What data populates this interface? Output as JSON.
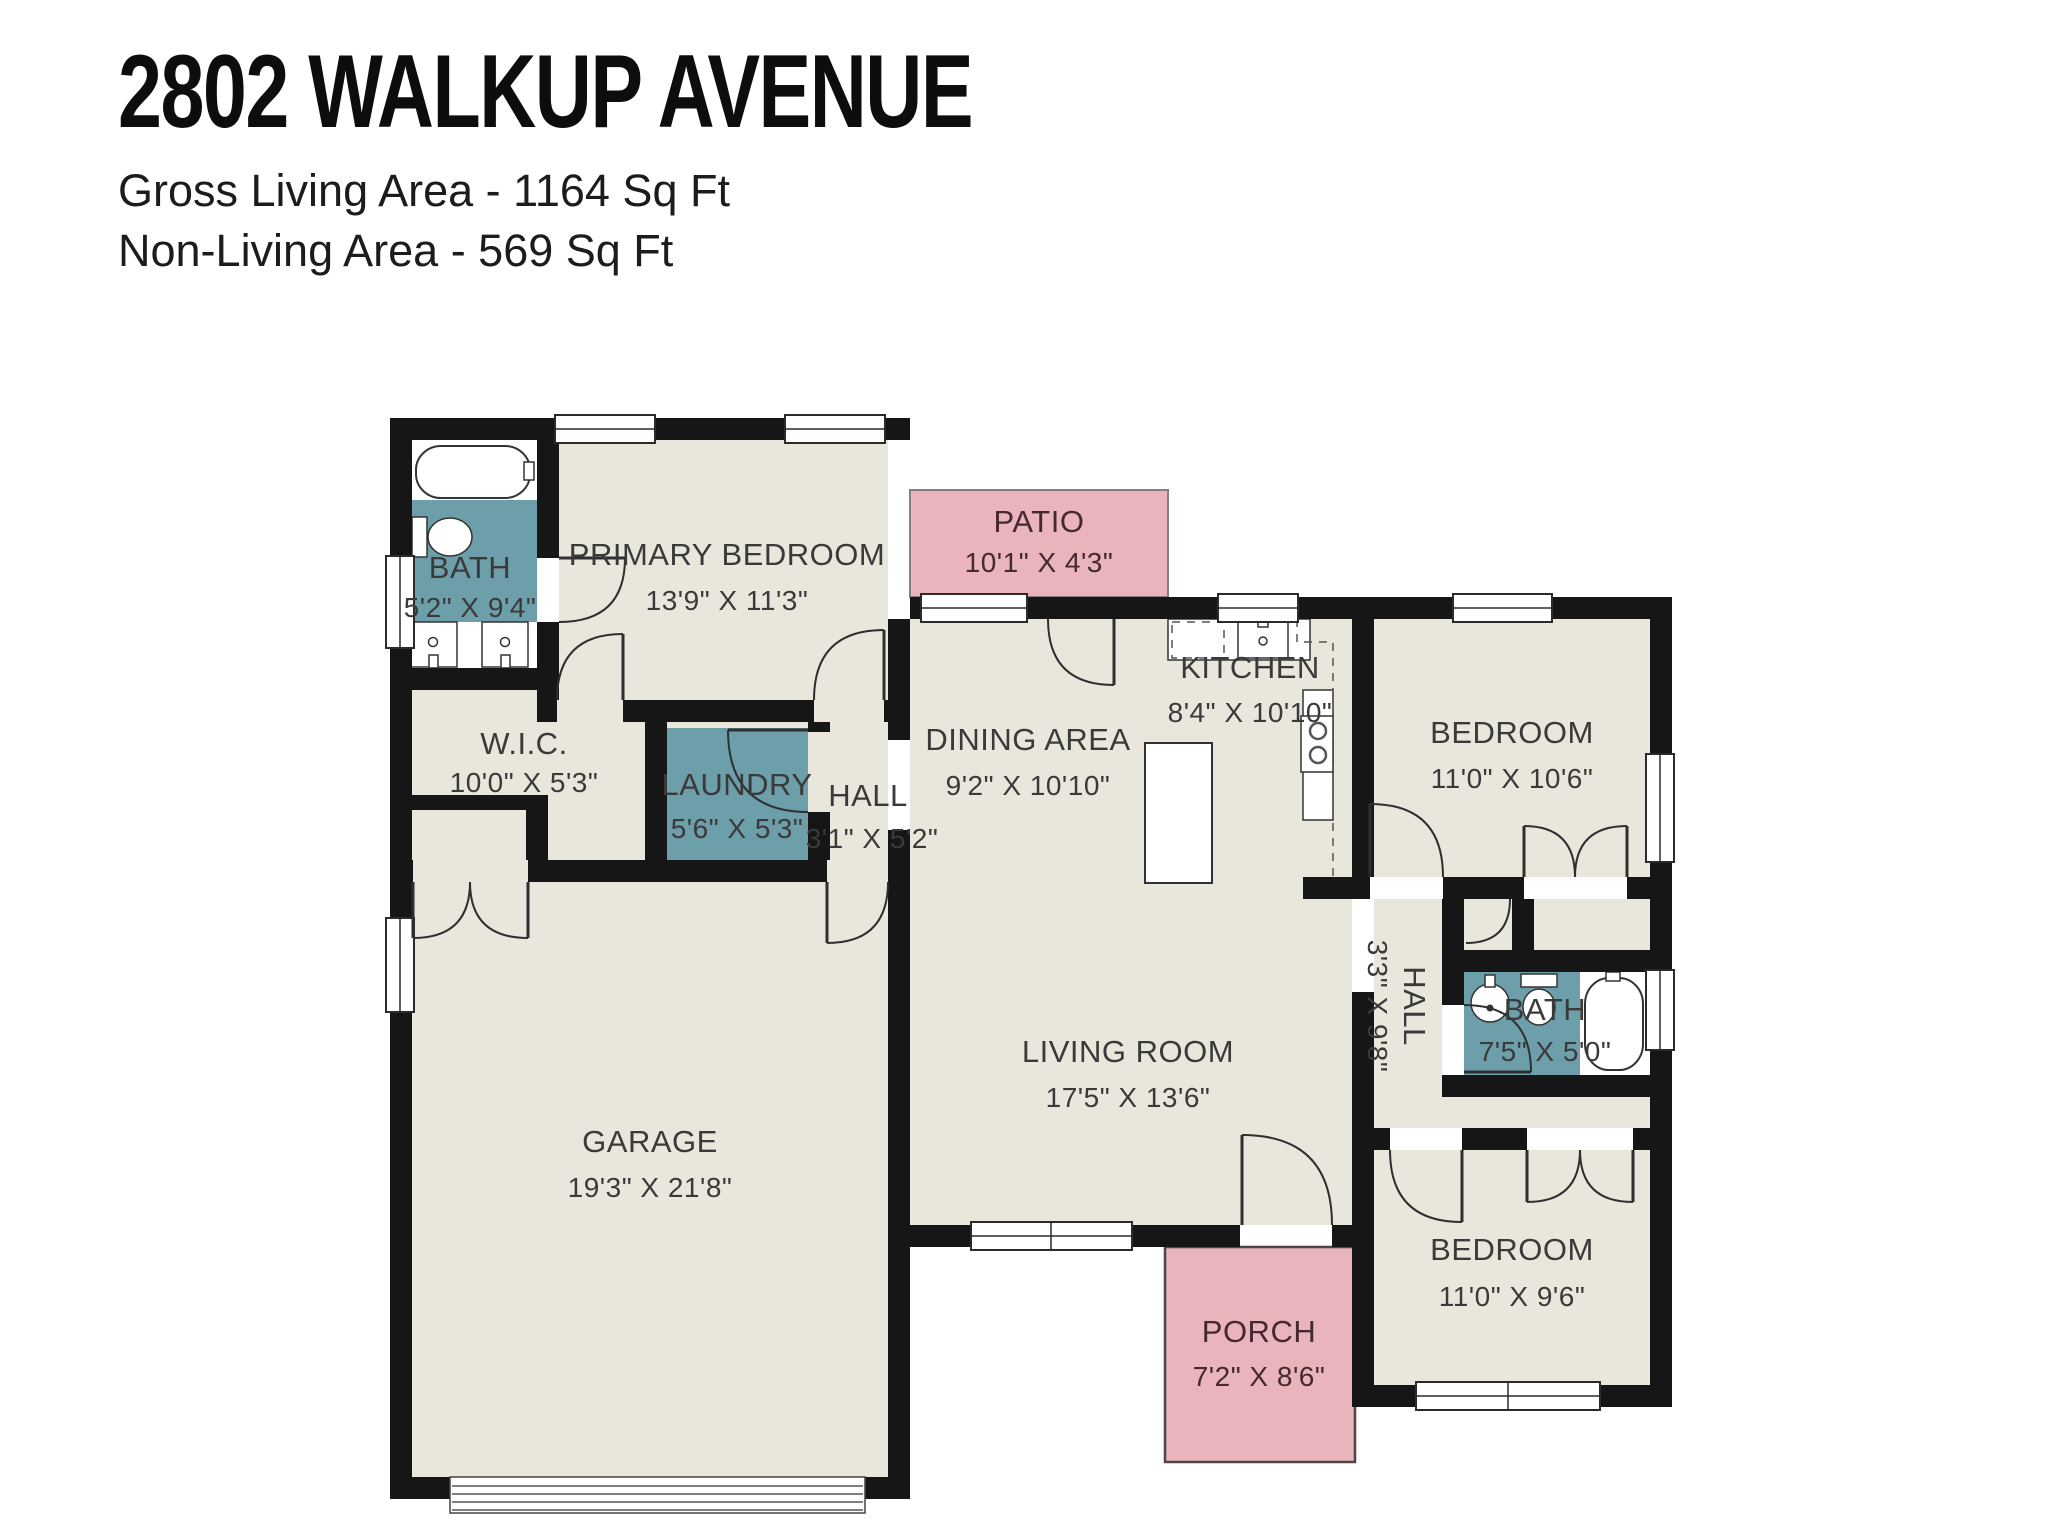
{
  "header": {
    "title": "2802 WALKUP AVENUE",
    "gross_living": "Gross Living Area - 1164 Sq Ft",
    "non_living": "Non-Living Area - 569 Sq Ft"
  },
  "rooms": [
    {
      "id": "bath-primary",
      "name": "BATH",
      "dims": "5'2\" X 9'4\""
    },
    {
      "id": "primary-bedroom",
      "name": "PRIMARY BEDROOM",
      "dims": "13'9\" X 11'3\""
    },
    {
      "id": "wic",
      "name": "W.I.C.",
      "dims": "10'0\" X 5'3\""
    },
    {
      "id": "laundry",
      "name": "LAUNDRY",
      "dims": "5'6\" X 5'3\""
    },
    {
      "id": "hall-center",
      "name": "HALL",
      "dims": "3'1\" X 5'2\""
    },
    {
      "id": "dining-area",
      "name": "DINING AREA",
      "dims": "9'2\" X 10'10\""
    },
    {
      "id": "kitchen",
      "name": "KITCHEN",
      "dims": "8'4\" X 10'10\""
    },
    {
      "id": "bedroom-ne",
      "name": "BEDROOM",
      "dims": "11'0\" X 10'6\""
    },
    {
      "id": "living-room",
      "name": "LIVING ROOM",
      "dims": "17'5\" X 13'6\""
    },
    {
      "id": "hall-east",
      "name": "HALL",
      "dims": "3'3\" X 9'8\""
    },
    {
      "id": "bath-east",
      "name": "BATH",
      "dims": "7'5\" X 5'0\""
    },
    {
      "id": "garage",
      "name": "GARAGE",
      "dims": "19'3\" X 21'8\""
    },
    {
      "id": "bedroom-se",
      "name": "BEDROOM",
      "dims": "11'0\" X 9'6\""
    }
  ],
  "outdoor": [
    {
      "id": "patio",
      "name": "PATIO",
      "dims": "10'1\" X 4'3\""
    },
    {
      "id": "porch",
      "name": "PORCH",
      "dims": "7'2\" X 8'6\""
    }
  ],
  "colors": {
    "wall": "#161616",
    "room_fill": "#e9e6dc",
    "wet_room_fill": "#6d9fab",
    "outdoor_fill": "#e9b4bc",
    "text": "#3a3a3a",
    "background": "#ffffff"
  }
}
